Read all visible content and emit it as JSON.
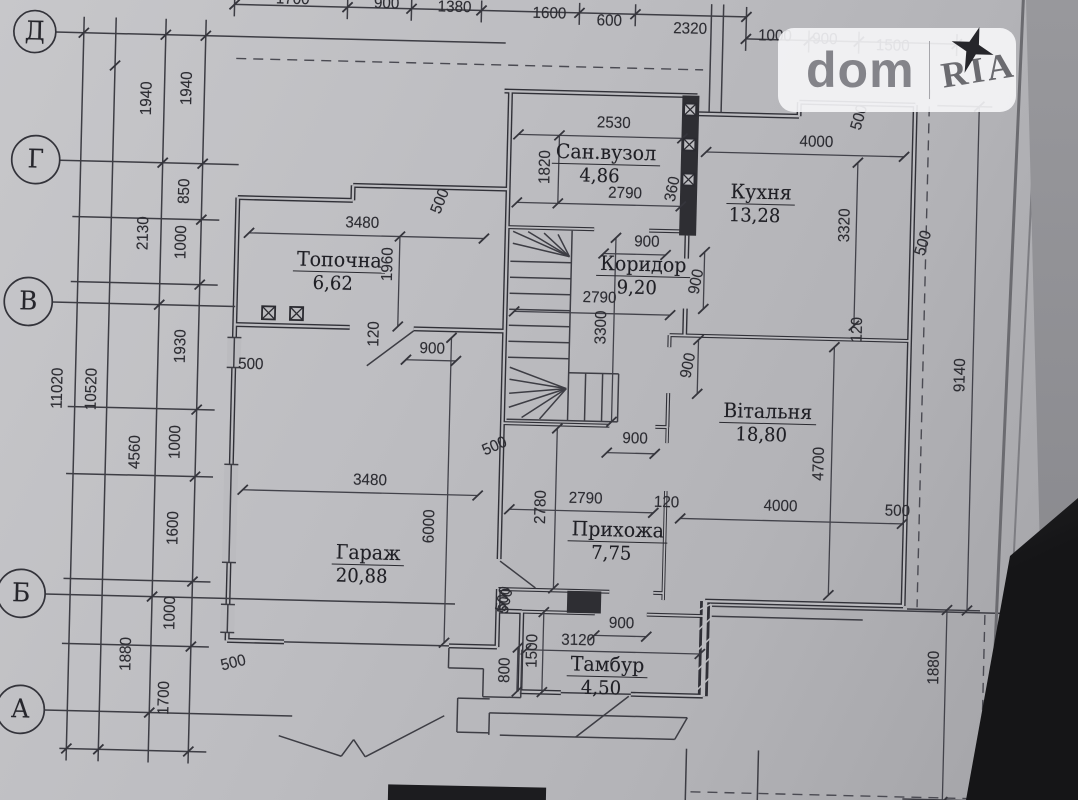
{
  "watermark": {
    "brand_left": "dom",
    "brand_right": "RIA"
  },
  "colors": {
    "paper": "#bbbbbf",
    "ink": "#303037",
    "watermark_bg": "rgba(246,246,248,0.9)"
  },
  "grid_rows": [
    {
      "label": "Д",
      "x": 26,
      "y": 44
    },
    {
      "label": "Г",
      "x": 30,
      "y": 172
    },
    {
      "label": "В",
      "x": 26,
      "y": 314
    },
    {
      "label": "Б",
      "x": 26,
      "y": 606
    },
    {
      "label": "А",
      "x": 28,
      "y": 722
    }
  ],
  "rooms": [
    {
      "name": "Сан.вузол",
      "area": "4,86",
      "x": 600,
      "y": 152
    },
    {
      "name": "Кухня",
      "area": "13,28",
      "x": 756,
      "y": 188
    },
    {
      "name": "Топочна",
      "area": "6,62",
      "x": 336,
      "y": 266
    },
    {
      "name": "Коридор",
      "area": "9,20",
      "x": 640,
      "y": 263
    },
    {
      "name": "Вітальня",
      "area": "18,80",
      "x": 768,
      "y": 407
    },
    {
      "name": "Гараж",
      "area": "20,88",
      "x": 372,
      "y": 558
    },
    {
      "name": "Прихожа",
      "area": "7,75",
      "x": 621,
      "y": 529
    },
    {
      "name": "Тамбур",
      "area": "4,50",
      "x": 614,
      "y": 664
    }
  ],
  "dim_labels": [
    {
      "t": "11020",
      "x": 58,
      "y": 400,
      "r": -90
    },
    {
      "t": "10520",
      "x": 92,
      "y": 400,
      "r": -90
    },
    {
      "t": "1940",
      "x": 140,
      "y": 108,
      "r": -90
    },
    {
      "t": "2130",
      "x": 140,
      "y": 243,
      "r": -90
    },
    {
      "t": "4560",
      "x": 137,
      "y": 462,
      "r": -90
    },
    {
      "t": "1880",
      "x": 133,
      "y": 664,
      "r": -90
    },
    {
      "t": "1940",
      "x": 180,
      "y": 97,
      "r": -90
    },
    {
      "t": "850",
      "x": 180,
      "y": 200,
      "r": -90
    },
    {
      "t": "1000",
      "x": 178,
      "y": 251,
      "r": -90
    },
    {
      "t": "1930",
      "x": 180,
      "y": 355,
      "r": -90
    },
    {
      "t": "1000",
      "x": 177,
      "y": 451,
      "r": -90
    },
    {
      "t": "1600",
      "x": 177,
      "y": 537,
      "r": -90
    },
    {
      "t": "1000",
      "x": 176,
      "y": 622,
      "r": -90
    },
    {
      "t": "1700",
      "x": 172,
      "y": 707,
      "r": -90
    },
    {
      "t": "1700",
      "x": 283,
      "y": 6,
      "r": 0
    },
    {
      "t": "900",
      "x": 377,
      "y": 8,
      "r": 0
    },
    {
      "t": "1380",
      "x": 445,
      "y": 10,
      "r": 0
    },
    {
      "t": "1600",
      "x": 540,
      "y": 14,
      "r": 0
    },
    {
      "t": "600",
      "x": 600,
      "y": 20,
      "r": 0
    },
    {
      "t": "2320",
      "x": 681,
      "y": 26,
      "r": 0
    },
    {
      "t": "1000",
      "x": 766,
      "y": 31,
      "r": 0
    },
    {
      "t": "900",
      "x": 816,
      "y": 33,
      "r": 0
    },
    {
      "t": "1500",
      "x": 884,
      "y": 38,
      "r": 0
    },
    {
      "t": "9140",
      "x": 960,
      "y": 365,
      "r": -90
    },
    {
      "t": "1880",
      "x": 941,
      "y": 658,
      "r": -90
    },
    {
      "t": "2530",
      "x": 607,
      "y": 122,
      "r": 0
    },
    {
      "t": "1820",
      "x": 540,
      "y": 167,
      "r": -90
    },
    {
      "t": "2790",
      "x": 620,
      "y": 192,
      "r": 0
    },
    {
      "t": "360",
      "x": 668,
      "y": 186,
      "r": -80
    },
    {
      "t": "4000",
      "x": 810,
      "y": 136,
      "r": 0
    },
    {
      "t": "3320",
      "x": 841,
      "y": 218,
      "r": -90
    },
    {
      "t": "500",
      "x": 920,
      "y": 234,
      "r": -75
    },
    {
      "t": "500",
      "x": 853,
      "y": 110,
      "r": -75
    },
    {
      "t": "3480",
      "x": 358,
      "y": 228,
      "r": 0
    },
    {
      "t": "1960",
      "x": 385,
      "y": 268,
      "r": -90
    },
    {
      "t": "500",
      "x": 436,
      "y": 204,
      "r": -70
    },
    {
      "t": "900",
      "x": 431,
      "y": 352,
      "r": 0
    },
    {
      "t": "120",
      "x": 373,
      "y": 338,
      "r": -90
    },
    {
      "t": "500",
      "x": 250,
      "y": 372,
      "r": 0
    },
    {
      "t": "500",
      "x": 240,
      "y": 671,
      "r": -15
    },
    {
      "t": "900",
      "x": 643,
      "y": 240,
      "r": 0
    },
    {
      "t": "2790",
      "x": 597,
      "y": 297,
      "r": 0
    },
    {
      "t": "3300",
      "x": 600,
      "y": 326,
      "r": -90
    },
    {
      "t": "900",
      "x": 694,
      "y": 278,
      "r": -80
    },
    {
      "t": "900",
      "x": 688,
      "y": 362,
      "r": -80
    },
    {
      "t": "4700",
      "x": 821,
      "y": 457,
      "r": -90
    },
    {
      "t": "4000",
      "x": 783,
      "y": 501,
      "r": 0
    },
    {
      "t": "500",
      "x": 900,
      "y": 503,
      "r": 0
    },
    {
      "t": "120",
      "x": 669,
      "y": 500,
      "r": 0
    },
    {
      "t": "120",
      "x": 856,
      "y": 322,
      "r": -90
    },
    {
      "t": "3480",
      "x": 372,
      "y": 485,
      "r": 0
    },
    {
      "t": "6000",
      "x": 433,
      "y": 529,
      "r": -90
    },
    {
      "t": "500",
      "x": 496,
      "y": 448,
      "r": -25
    },
    {
      "t": "500",
      "x": 511,
      "y": 602,
      "r": -80
    },
    {
      "t": "2790",
      "x": 588,
      "y": 498,
      "r": 0
    },
    {
      "t": "2780",
      "x": 544,
      "y": 507,
      "r": -90
    },
    {
      "t": "900",
      "x": 636,
      "y": 437,
      "r": 0
    },
    {
      "t": "3120",
      "x": 584,
      "y": 640,
      "r": 0
    },
    {
      "t": "900",
      "x": 627,
      "y": 622,
      "r": 0
    },
    {
      "t": "1500",
      "x": 539,
      "y": 651,
      "r": -90
    },
    {
      "t": "800",
      "x": 512,
      "y": 671,
      "r": -90
    },
    {
      "t": "500",
      "x": 509,
      "y": 600,
      "r": -80
    }
  ],
  "geometry": {
    "walls": [
      [
        497,
        92,
        690,
        92
      ],
      [
        503,
        92,
        503,
        424
      ],
      [
        690,
        110,
        792,
        110
      ],
      [
        792,
        110,
        792,
        96
      ],
      [
        792,
        96,
        908,
        96
      ],
      [
        908,
        96,
        908,
        597
      ],
      [
        908,
        597,
        710,
        597
      ],
      [
        710,
        597,
        710,
        692,
        10
      ],
      [
        710,
        692,
        638,
        692
      ],
      [
        568,
        692,
        527,
        692
      ],
      [
        527,
        692,
        527,
        612
      ],
      [
        527,
        612,
        503,
        612
      ],
      [
        503,
        424,
        503,
        560
      ],
      [
        503,
        590,
        503,
        648
      ],
      [
        503,
        648,
        455,
        648
      ],
      [
        290,
        648,
        233,
        648
      ],
      [
        233,
        648,
        233,
        205
      ],
      [
        233,
        205,
        348,
        205
      ],
      [
        348,
        205,
        348,
        190
      ],
      [
        348,
        190,
        503,
        190
      ],
      [
        233,
        332,
        348,
        332
      ],
      [
        412,
        332,
        503,
        332
      ],
      [
        503,
        228,
        590,
        228,
        4
      ],
      [
        645,
        228,
        683,
        228,
        4
      ],
      [
        683,
        232,
        683,
        255
      ],
      [
        683,
        305,
        683,
        332
      ],
      [
        668,
        332,
        668,
        344,
        4
      ],
      [
        668,
        390,
        668,
        424,
        4
      ],
      [
        668,
        424,
        668,
        440,
        3.5
      ],
      [
        668,
        488,
        668,
        597,
        3.5
      ],
      [
        503,
        424,
        610,
        424,
        4
      ],
      [
        656,
        424,
        668,
        424,
        4
      ],
      [
        668,
        332,
        908,
        332,
        4
      ],
      [
        527,
        612,
        600,
        612,
        4
      ],
      [
        652,
        612,
        710,
        612,
        4
      ],
      [
        503,
        590,
        614,
        590,
        4
      ],
      [
        658,
        590,
        668,
        590,
        4
      ]
    ],
    "fills": [
      [
        675,
        92,
        17,
        140
      ],
      [
        572,
        590,
        34,
        22
      ]
    ],
    "gaps": [
      [
        226,
        345,
        14,
        30
      ],
      [
        226,
        472,
        14,
        98
      ],
      [
        226,
        612,
        14,
        28
      ]
    ],
    "hatch": [
      [
        704,
        686,
        716,
        674
      ],
      [
        704,
        666,
        716,
        654
      ],
      [
        704,
        646,
        716,
        634
      ],
      [
        704,
        626,
        716,
        614
      ],
      [
        704,
        606,
        716,
        600
      ]
    ],
    "lines": [
      [
        507,
        262,
        568,
        262
      ],
      [
        507,
        278,
        568,
        278
      ],
      [
        507,
        294,
        568,
        294
      ],
      [
        507,
        310,
        568,
        310
      ],
      [
        507,
        326,
        568,
        326
      ],
      [
        507,
        342,
        568,
        342
      ],
      [
        507,
        358,
        568,
        358
      ],
      [
        568,
        230,
        568,
        420
      ],
      [
        507,
        420,
        568,
        420
      ],
      [
        566,
        256,
        509,
        232
      ],
      [
        566,
        256,
        509,
        244
      ],
      [
        566,
        256,
        524,
        232
      ],
      [
        566,
        256,
        540,
        233
      ],
      [
        566,
        256,
        554,
        234
      ],
      [
        566,
        388,
        509,
        368
      ],
      [
        566,
        388,
        509,
        380
      ],
      [
        566,
        388,
        509,
        394
      ],
      [
        566,
        388,
        509,
        408
      ],
      [
        566,
        388,
        522,
        418
      ],
      [
        566,
        388,
        540,
        419
      ],
      [
        568,
        372,
        618,
        372
      ],
      [
        618,
        372,
        618,
        420
      ],
      [
        568,
        420,
        618,
        420
      ],
      [
        585,
        372,
        585,
        420
      ],
      [
        602,
        372,
        602,
        420
      ],
      [
        568,
        692,
        638,
        692
      ],
      [
        290,
        648,
        455,
        648
      ],
      [
        233,
        345,
        233,
        375
      ],
      [
        233,
        472,
        233,
        570
      ],
      [
        233,
        612,
        233,
        640
      ],
      [
        226,
        345,
        240,
        345
      ],
      [
        226,
        375,
        240,
        375
      ],
      [
        226,
        472,
        240,
        472
      ],
      [
        226,
        570,
        240,
        570
      ],
      [
        226,
        612,
        240,
        612
      ],
      [
        226,
        640,
        240,
        640
      ],
      [
        412,
        334,
        366,
        370
      ],
      [
        504,
        562,
        540,
        588
      ],
      [
        636,
        694,
        584,
        736
      ],
      [
        455,
        670,
        490,
        670
      ],
      [
        490,
        670,
        490,
        698
      ],
      [
        490,
        698,
        528,
        698
      ],
      [
        528,
        698,
        528,
        650
      ],
      [
        455,
        650,
        455,
        670
      ],
      [
        497,
        714,
        695,
        714
      ],
      [
        508,
        736,
        683,
        736
      ],
      [
        497,
        714,
        497,
        736
      ],
      [
        695,
        714,
        683,
        736
      ],
      [
        465,
        700,
        497,
        700
      ],
      [
        465,
        734,
        497,
        734
      ],
      [
        465,
        700,
        465,
        734
      ],
      [
        287,
        742,
        350,
        761
      ],
      [
        350,
        761,
        362,
        744
      ],
      [
        362,
        744,
        374,
        761
      ],
      [
        374,
        761,
        452,
        718
      ],
      [
        717,
        602,
        1012,
        602
      ],
      [
        717,
        612,
        868,
        612
      ],
      [
        695,
        745,
        695,
        800
      ],
      [
        767,
        745,
        767,
        800
      ],
      [
        702,
        0,
        702,
        108
      ],
      [
        714,
        0,
        714,
        108
      ],
      [
        47,
        44,
        497,
        44
      ],
      [
        54,
        172,
        233,
        172
      ],
      [
        50,
        314,
        233,
        314
      ],
      [
        50,
        606,
        460,
        606
      ],
      [
        52,
        722,
        300,
        722
      ],
      [
        75,
        28,
        75,
        772
      ],
      [
        107,
        28,
        107,
        772
      ],
      [
        157,
        28,
        157,
        772
      ],
      [
        197,
        28,
        197,
        772
      ],
      [
        68,
        228,
        215,
        228
      ],
      [
        68,
        293,
        215,
        293
      ],
      [
        68,
        418,
        215,
        418
      ],
      [
        68,
        485,
        215,
        485
      ],
      [
        68,
        590,
        215,
        590
      ],
      [
        68,
        655,
        215,
        655
      ],
      [
        68,
        760,
        215,
        760
      ],
      [
        225,
        12,
        737,
        12
      ],
      [
        737,
        34,
        948,
        34
      ],
      [
        225,
        2,
        225,
        24
      ],
      [
        338,
        2,
        338,
        24
      ],
      [
        402,
        2,
        402,
        24
      ],
      [
        472,
        2,
        472,
        24
      ],
      [
        570,
        2,
        570,
        24
      ],
      [
        626,
        2,
        626,
        24
      ],
      [
        737,
        2,
        737,
        46
      ],
      [
        800,
        24,
        800,
        46
      ],
      [
        850,
        24,
        850,
        46
      ],
      [
        948,
        24,
        948,
        46
      ],
      [
        912,
        600,
        985,
        600
      ],
      [
        912,
        790,
        985,
        790
      ],
      [
        930,
        96,
        985,
        96
      ]
    ],
    "dashes": [
      [
        228,
        66,
        695,
        66
      ],
      [
        922,
        80,
        922,
        598
      ],
      [
        990,
        604,
        990,
        792
      ],
      [
        700,
        788,
        985,
        788
      ]
    ],
    "dims": [
      [
        512,
        135,
        676,
        135
      ],
      [
        700,
        148,
        898,
        148
      ],
      [
        512,
        203,
        676,
        203
      ],
      [
        553,
        135,
        553,
        203
      ],
      [
        852,
        155,
        852,
        318
      ],
      [
        245,
        240,
        480,
        240
      ],
      [
        396,
        240,
        396,
        330
      ],
      [
        600,
        252,
        662,
        252
      ],
      [
        512,
        312,
        668,
        312
      ],
      [
        612,
        236,
        612,
        420
      ],
      [
        701,
        248,
        701,
        305
      ],
      [
        697,
        336,
        697,
        390
      ],
      [
        833,
        340,
        833,
        588
      ],
      [
        683,
        515,
        905,
        515
      ],
      [
        245,
        497,
        480,
        497
      ],
      [
        450,
        340,
        450,
        645
      ],
      [
        512,
        510,
        656,
        510
      ],
      [
        558,
        428,
        558,
        588
      ],
      [
        608,
        451,
        656,
        451
      ],
      [
        405,
        363,
        455,
        363
      ],
      [
        532,
        650,
        706,
        650
      ],
      [
        600,
        634,
        652,
        634
      ],
      [
        549,
        612,
        549,
        692
      ],
      [
        524,
        648,
        524,
        692
      ],
      [
        972,
        96,
        972,
        600
      ],
      [
        952,
        600,
        952,
        792
      ]
    ],
    "ticks": [
      [
        75,
        44
      ],
      [
        75,
        760
      ],
      [
        107,
        76
      ],
      [
        107,
        760
      ],
      [
        157,
        44
      ],
      [
        157,
        172
      ],
      [
        157,
        314
      ],
      [
        157,
        606
      ],
      [
        157,
        722
      ],
      [
        197,
        44
      ],
      [
        197,
        172
      ],
      [
        197,
        228
      ],
      [
        197,
        293
      ],
      [
        197,
        418
      ],
      [
        197,
        485
      ],
      [
        197,
        590
      ],
      [
        197,
        655
      ],
      [
        197,
        760
      ],
      [
        225,
        12
      ],
      [
        338,
        12
      ],
      [
        402,
        12
      ],
      [
        472,
        12
      ],
      [
        570,
        12
      ],
      [
        626,
        12
      ],
      [
        737,
        12
      ],
      [
        737,
        34
      ],
      [
        800,
        34
      ],
      [
        850,
        34
      ],
      [
        948,
        34
      ]
    ],
    "squares": [
      [
        677,
        100,
        12
      ],
      [
        677,
        135,
        12
      ],
      [
        677,
        170,
        12
      ],
      [
        260,
        313,
        13
      ],
      [
        288,
        313,
        13
      ]
    ],
    "circles": [
      [
        26,
        44,
        21
      ],
      [
        30,
        172,
        24
      ],
      [
        26,
        314,
        24
      ],
      [
        26,
        606,
        24
      ],
      [
        28,
        722,
        24
      ]
    ]
  }
}
